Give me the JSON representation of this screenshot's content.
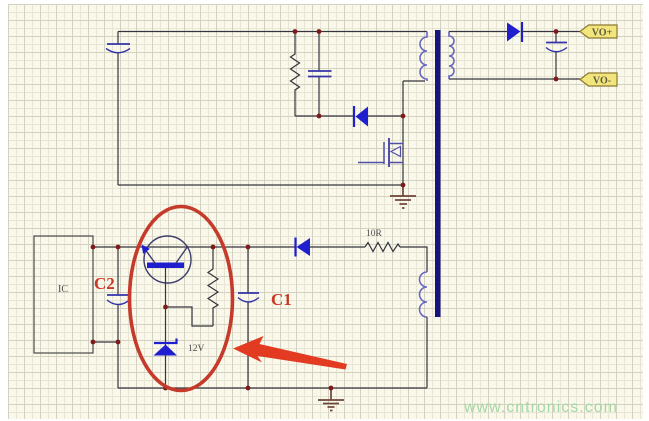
{
  "diagram_type": "flyback-power-supply-schematic",
  "labels": {
    "ic": "IC",
    "c2": "C2",
    "c1": "C1",
    "zener_voltage": "12V",
    "series_resistor": "10R"
  },
  "flags": {
    "vo_plus": "VO+",
    "vo_minus": "VO-"
  },
  "watermark": "www.cntronics.com",
  "components": {
    "input_capacitor": "polarized-capacitor",
    "snubber_resistor": "resistor",
    "snubber_capacitor": "capacitor",
    "clamp_diode": "diode-left",
    "power_mosfet": "n-mosfet",
    "transformer": "transformer-three-windings",
    "output_diode": "diode-right",
    "output_capacitor": "polarized-capacitor",
    "ic_block": "ic-box",
    "c2_capacitor": "polarized-capacitor",
    "pass_transistor": "transistor-circle",
    "collector_resistor": "resistor",
    "zener_diode": "zener-12v",
    "c1_capacitor": "polarized-capacitor",
    "feedback_diode": "diode-left",
    "series_resistor_10r": "resistor",
    "ground_top": "ground",
    "ground_bottom": "ground",
    "highlight_ellipse": "red-ellipse-annotation",
    "annotation_arrow": "red-arrow-annotation"
  },
  "colors": {
    "background": "#faf8ea",
    "grid_minor": "#e7e5d3",
    "grid_major": "#d3d1bf",
    "wire": "#34343e",
    "component_blue": "#1f1fd0",
    "winding_blue": "#6868c2",
    "core_navy": "#15157e",
    "junction_dot": "#7e1a1a",
    "annotation_red": "#c53a2b",
    "arrow_red": "#e23b22",
    "flag_fill": "#f3e57d",
    "flag_border": "#8a7a30",
    "ground_brown": "#6e4438",
    "watermark_green": "#a6d7a6",
    "red_label": "#c93826"
  }
}
